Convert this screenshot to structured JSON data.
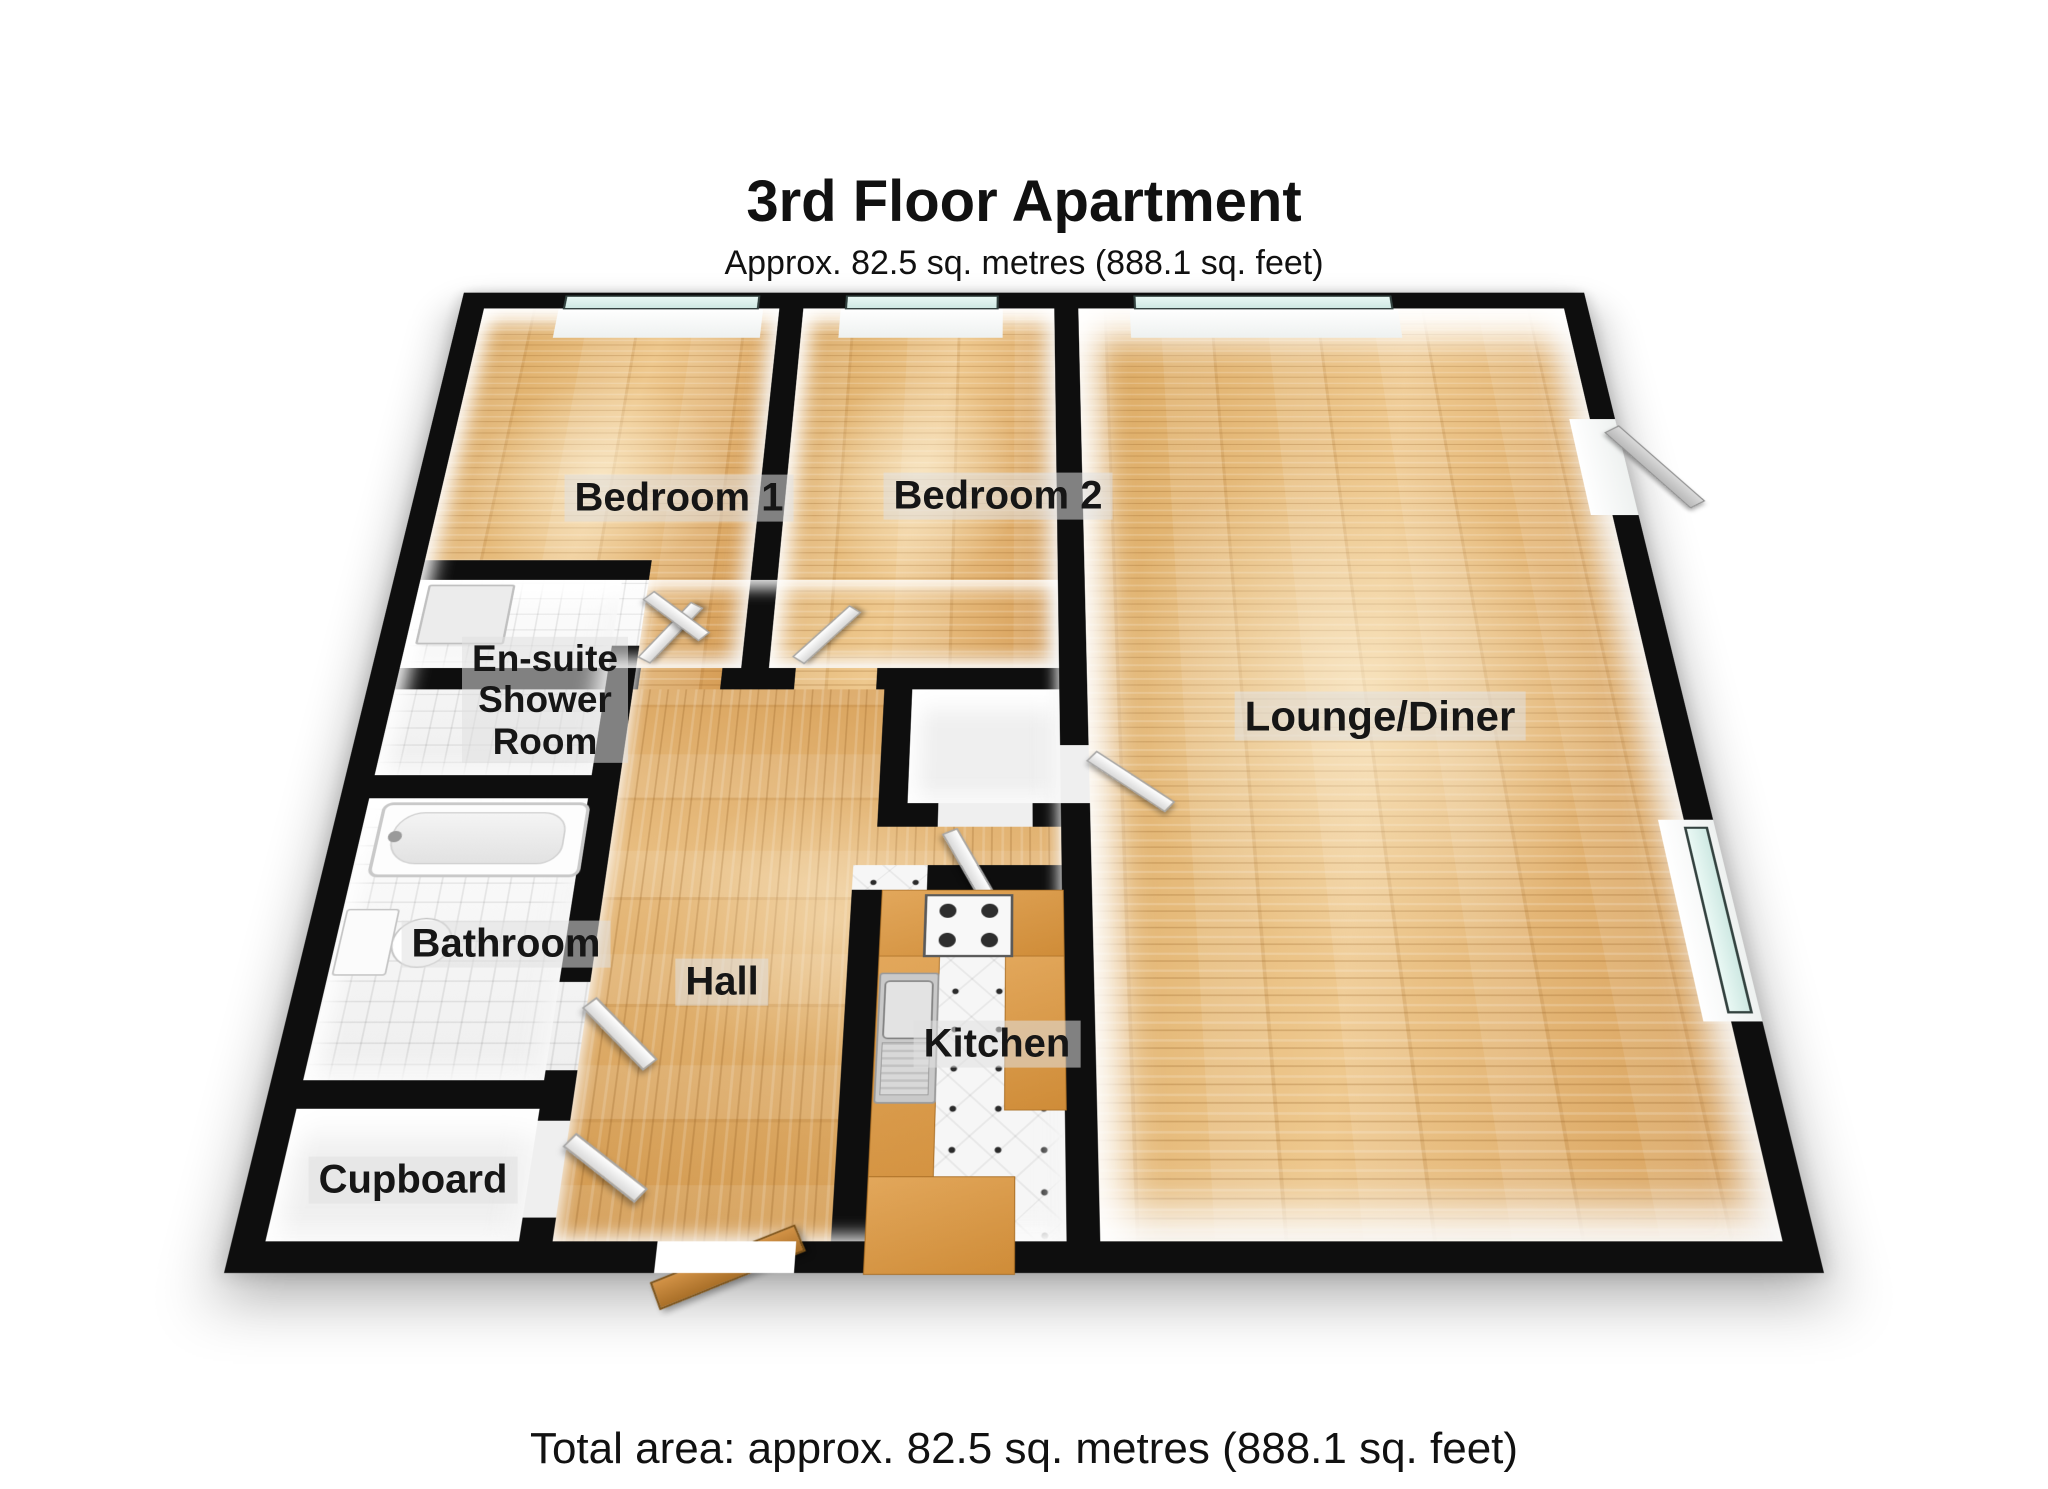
{
  "header": {
    "title": "3rd Floor Apartment",
    "subtitle": "Approx. 82.5 sq. metres (888.1 sq. feet)"
  },
  "rooms": {
    "bedroom1": "Bedroom 1",
    "bedroom2": "Bedroom 2",
    "ensuite": "En-suite\nShower\nRoom",
    "bathroom": "Bathroom",
    "hall": "Hall",
    "cupboard": "Cupboard",
    "kitchen": "Kitchen",
    "lounge": "Lounge/Diner"
  },
  "footer": {
    "total_area": "Total area: approx. 82.5 sq. metres (888.1 sq. feet)"
  },
  "colors": {
    "wall": "#0e0e0e",
    "wood_floor": "#e0b273",
    "hall_floor": "#d9a25c",
    "kitchen_counter": "#d6953f",
    "window_glass": "#d8efe9",
    "bathroom_tile": "#f4f4f4"
  }
}
